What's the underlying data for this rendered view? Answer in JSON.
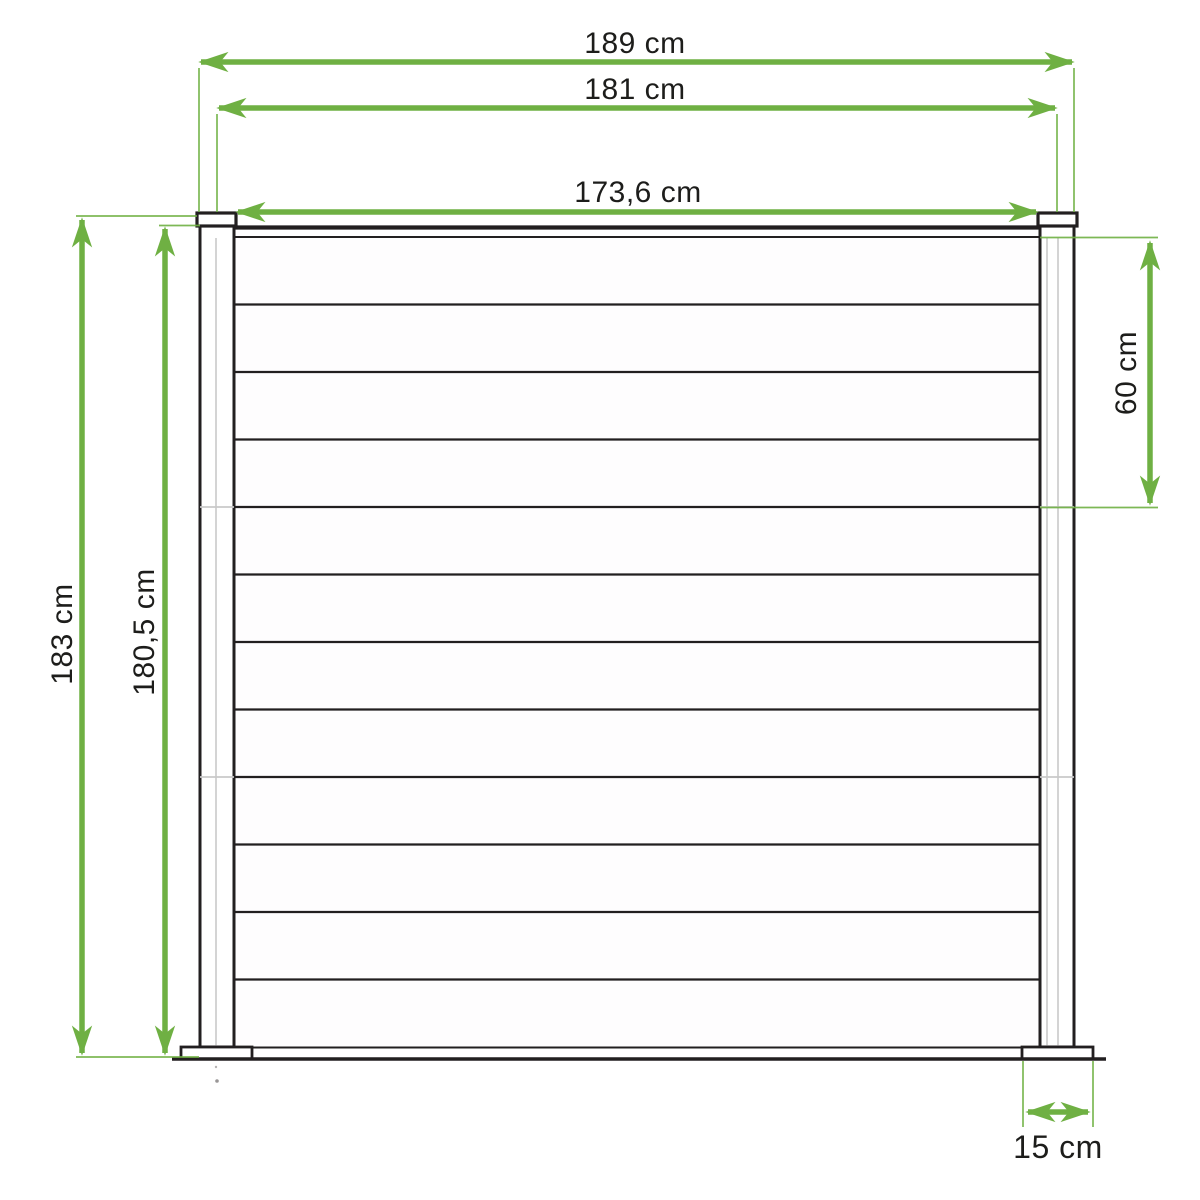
{
  "diagram": {
    "kind": "fence-panel-technical-drawing",
    "unit": "cm",
    "decimal_separator": ","
  },
  "colors": {
    "dimension_green": "#6fb043",
    "outline_dark": "#221f20",
    "divider_gray": "#c9c9c9",
    "background": "#ffffff"
  },
  "dimensions": {
    "total_width": {
      "label": "189 cm",
      "value": 189
    },
    "post_center_width": {
      "label": "181 cm",
      "value": 181
    },
    "panel_width": {
      "label": "173,6 cm",
      "value": 173.6
    },
    "total_height": {
      "label": "183 cm",
      "value": 183
    },
    "panel_height": {
      "label": "180,5 cm",
      "value": 180.5
    },
    "section_height": {
      "label": "60 cm",
      "value": 60
    },
    "base_plate_width": {
      "label": "15 cm",
      "value": 15
    }
  },
  "fence": {
    "post_count": 2,
    "slat_count": 12,
    "section_count": 3,
    "section_divider_after_slats": [
      4,
      8
    ]
  }
}
